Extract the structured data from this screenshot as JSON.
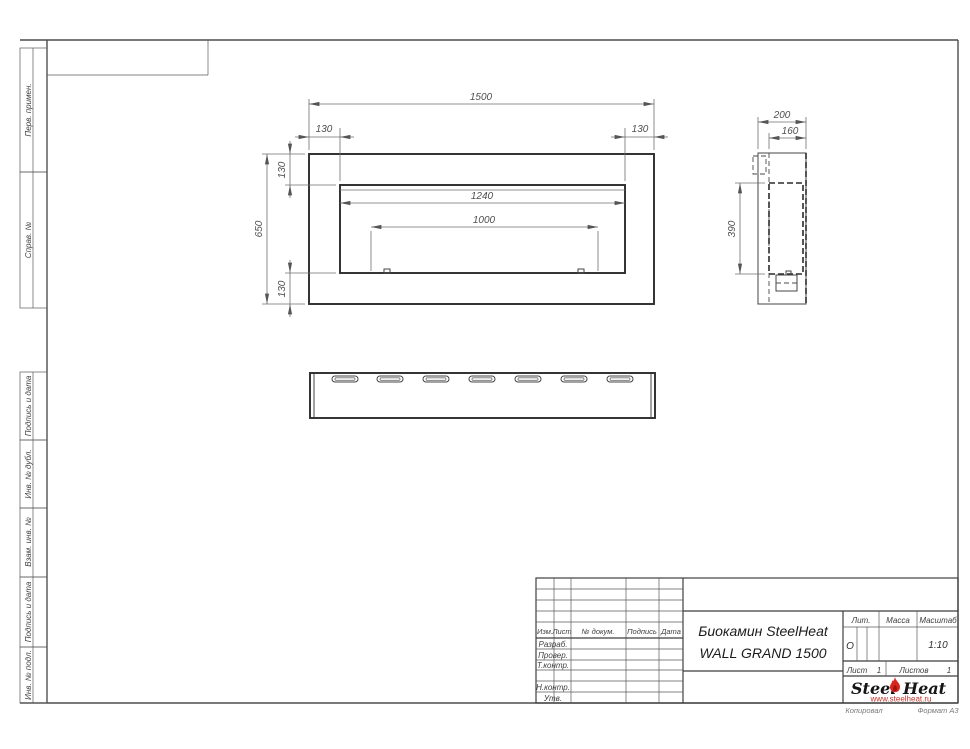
{
  "margins": {
    "sidebar": [
      {
        "label": "Перв. примен."
      },
      {
        "label": "Справ. №"
      },
      {
        "label": "Подпись и дата"
      },
      {
        "label": "Инв. № дубл."
      },
      {
        "label": "Взам. инв. №"
      },
      {
        "label": "Подпись и дата"
      },
      {
        "label": "Инв. № подл."
      }
    ],
    "copied": "Копировал",
    "format": "Формат А3"
  },
  "views": {
    "front": {
      "width": "1500",
      "height": "650",
      "margin_left": "130",
      "margin_right": "130",
      "margin_top": "130",
      "margin_bottom": "130",
      "opening_width": "1240",
      "burner_width": "1000"
    },
    "side": {
      "depth": "200",
      "inner_depth": "160",
      "opening_height": "390"
    }
  },
  "title_block": {
    "change_header": {
      "izm": "Изм.",
      "list": "Лист",
      "doc": "№ докум.",
      "sign": "Подпись",
      "date": "Дата"
    },
    "roles": {
      "developed": "Разраб.",
      "checked": "Провер.",
      "tcontrol": "Т.контр.",
      "ncontrol": "Н.контр.",
      "approved": "Утв."
    },
    "product": {
      "line1": "Биокамин SteelHeat",
      "line2": "WALL GRAND 1500"
    },
    "lit": {
      "label": "Лит.",
      "value": "О"
    },
    "mass": {
      "label": "Масса"
    },
    "scale": {
      "label": "Масштаб",
      "value": "1:10"
    },
    "sheet": {
      "label": "Лист",
      "value": "1"
    },
    "sheets": {
      "label": "Листов",
      "value": "1"
    },
    "logo": {
      "steel": "Steel",
      "heat": "Heat",
      "url": "www.steelheat.ru"
    }
  },
  "colors": {
    "brand_red": "#d7261e",
    "url_red": "#c6352a",
    "line_dark": "#2b2b2b",
    "line_thin": "#6f6f6f"
  }
}
